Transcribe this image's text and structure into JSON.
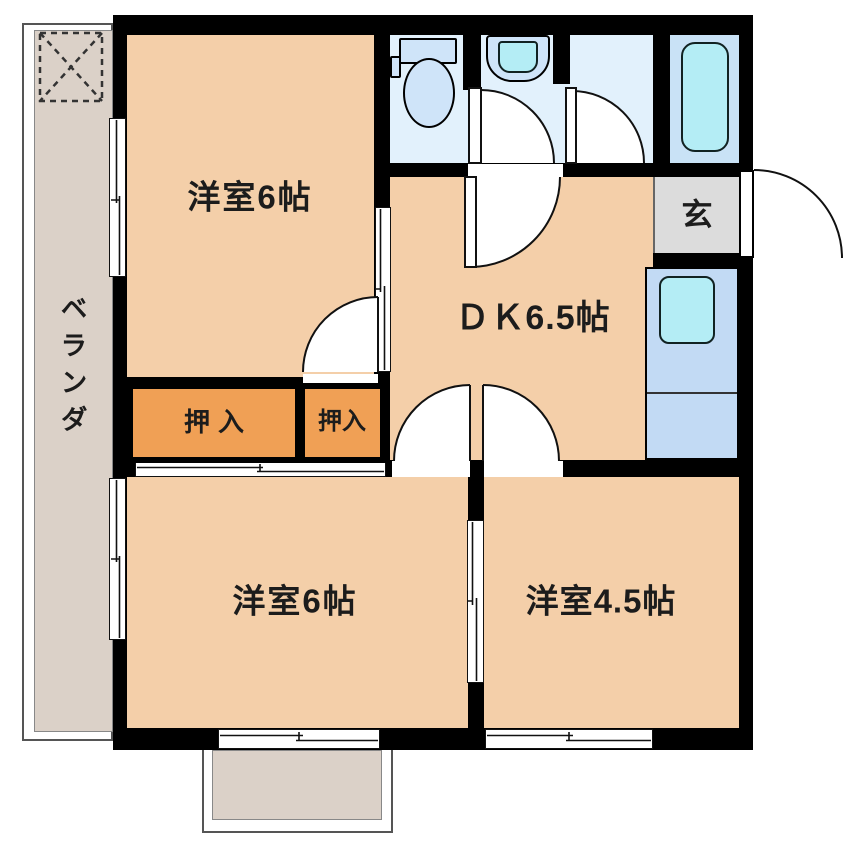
{
  "title": "apartment-floor-plan",
  "rooms": {
    "room_top": {
      "label": "洋室6帖"
    },
    "dk": {
      "label": "ＤＫ6.5帖"
    },
    "genkan": {
      "label": "玄"
    },
    "closet_left": {
      "label": "押入"
    },
    "closet_right": {
      "label": "押入"
    },
    "room_bottom_left": {
      "label": "洋室6帖"
    },
    "room_bottom_right": {
      "label": "洋室4.5帖"
    },
    "veranda": {
      "label": "ベランダ"
    }
  },
  "colors": {
    "peach": "#f4cfa9",
    "wet": "#e2f1fc",
    "bath": "#c9e2f6",
    "cyan": "#b4edf5",
    "fixture": "#cfe4f9",
    "counter": "#c2daf4",
    "closet": "#f0a055",
    "genkan": "#dcdcdc",
    "balcony": "#dbd1c8",
    "wall": "#000000",
    "text": "#1c1c1c"
  }
}
